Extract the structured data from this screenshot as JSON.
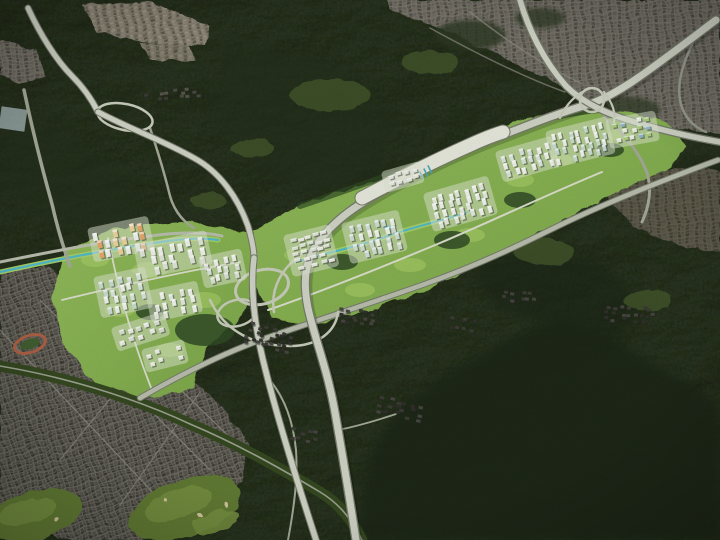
{
  "meta": {
    "type": "aerial-masterplan-rendering",
    "description": "Oblique aerial rendering of a planned new town: white apartment towers and green parks inserted along a highway corridor between dark forested mountains, with existing dense gray city districts and two major freeway interchanges.",
    "width": 720,
    "height": 540
  },
  "colors": {
    "forest_base": "#2b3721",
    "forest_dark": "#1b2516",
    "forest_shade": "#232e1b",
    "meadow": "#42552c",
    "city_bg": "#6b695f",
    "citygray_bg": "#767268",
    "beige_bg": "#847d6c",
    "dev_base": "#84ae4f",
    "dev_light": "#a6cc66",
    "park_dark": "#2f4a24",
    "golf": "#5e7833",
    "golf_light": "#728c3e",
    "bunker": "#cfc39a",
    "track_ring": "#a95f43",
    "track_infield": "#3f5c2e",
    "greenhouse": "#aebfc2",
    "pond": "#55bcca",
    "toll_plaza": "#e6e8dc"
  },
  "class_colors": {
    "road-casing": "#75796b",
    "road-fill": "#cdd1c3",
    "road-bright": "#e4e6da",
    "road-arterial": "#b6bbaa",
    "road-minor": "#a2a796",
    "road-thin": "#95998b",
    "road-shadow": "rgba(0,0,0,0.18)",
    "stream": "#4db7c7",
    "stream-bank": "#a6cc66",
    "boulevard-band": "#33471f",
    "boulevard-line": "#9aa08e",
    "dev-road": "#d8dcc9",
    "loop-ramp": "#c6cab9",
    "street-line": "#8d8a80",
    "belt-trees": "#2f4a24"
  },
  "roads": {
    "r_topleft": "M28,8 C40,34 56,60 72,76 C84,88 92,100 98,112",
    "r_topleft2": "M98,112 C128,128 162,140 194,158 C220,172 238,198 248,226 C252,240 254,250 254,258",
    "r_south_a": "M254,258 C250,290 255,330 266,372 C278,420 296,478 316,540",
    "expressway": "M356,540 C348,488 342,452 336,418 C328,370 315,340 308,308 C302,278 306,258 320,240 C338,216 365,200 395,184 C432,164 472,146 508,133 C536,122 562,112 590,104 C615,95 640,77 668,56 C690,40 705,28 716,20",
    "expressway_bright": "M362,198 C398,179 434,161 470,145 C483,139 493,135 503,132",
    "expressway2": "M520,0 C528,28 543,60 566,86 C580,100 598,110 622,118 C652,128 686,136 720,142",
    "arterial": "M140,398 C185,372 230,350 272,336 C330,316 380,300 425,284 C470,268 510,250 550,230 C590,210 650,185 718,160",
    "north_arterial_west": "M0,262 C50,252 100,242 150,236 C180,232 205,232 222,236",
    "stream_west": "M0,272 C55,260 115,248 168,241 C190,238 205,238 218,240",
    "stream_east": "M296,262 C330,252 360,246 382,238 C412,227 438,222 468,212",
    "left_road": "M24,90 C32,128 42,168 52,204 C57,226 62,244 70,266",
    "junction_spur": "M150,128 C158,152 164,172 169,192 C172,206 180,220 194,228",
    "ne_se_branch": "M604,116 C622,132 638,150 646,170 C652,186 650,205 642,222",
    "right_wind": "M700,28 C688,52 676,76 680,100 C683,116 692,126 706,132",
    "boulevard": "M0,366 C60,376 130,396 190,424 C235,443 275,465 320,492 C340,504 352,520 362,540",
    "village_road": "M268,378 C284,396 293,420 296,450 C298,478 294,508 288,540",
    "spur_hamlet": "M338,430 C358,426 378,420 396,414",
    "belt_road": "M268,310 C320,292 380,268 440,243 C492,221 544,196 602,172",
    "dev_road_w1": "M62,300 C120,286 180,272 240,262",
    "dev_road_w2": "M108,238 C118,288 132,340 152,390",
    "ramp1": "M210,300 C225,332 255,346 290,346 C320,346 336,330 338,312",
    "ramp2": "M302,254 C282,268 270,288 274,312",
    "belt_tree_line": "M300,206 C360,186 430,160 500,134 C540,120 570,112 600,110",
    "street_p2_a": "M430,28 C470,50 520,76 565,92",
    "street_p2_b": "M470,12 C505,40 545,66 582,84"
  },
  "regions": {
    "development_west": {
      "name": "western new-town cluster"
    },
    "development_east": {
      "name": "eastern new-town corridor"
    },
    "city_southwest": {
      "name": "existing dense low-rise city"
    },
    "city_northeast": {
      "name": "existing hillside city"
    },
    "interchange_central": {
      "name": "central freeway interchange"
    },
    "interchange_northeast": {
      "name": "northeast freeway crossing"
    }
  },
  "building_clusters": [
    {
      "id": "w-orange-towers",
      "x": 94,
      "y": 233,
      "a": -12,
      "r": 3,
      "c": 6,
      "dx": 9,
      "dy": 9,
      "w": 4.5,
      "h": 8,
      "j": 2,
      "seed": 1,
      "pad": true,
      "t": true,
      "p": [
        "#e2a566",
        "#ecd09c",
        "#edefe9"
      ]
    },
    {
      "id": "w-upper-towers",
      "x": 140,
      "y": 250,
      "a": -12,
      "r": 3,
      "c": 7,
      "dx": 9.5,
      "dy": 9,
      "w": 4.5,
      "h": 8,
      "j": 2,
      "seed": 2,
      "pad": true,
      "t": true,
      "p": [
        "#edefe9",
        "#dde3d8"
      ]
    },
    {
      "id": "w-teal-towers",
      "x": 100,
      "y": 282,
      "a": -12,
      "r": 4,
      "c": 5,
      "dx": 9,
      "dy": 8.5,
      "w": 4,
      "h": 7,
      "j": 2,
      "seed": 3,
      "pad": true,
      "t": true,
      "p": [
        "#c6dad0",
        "#edefe9",
        "#d7e2da"
      ]
    },
    {
      "id": "w-mid-towers",
      "x": 152,
      "y": 296,
      "a": -12,
      "r": 3,
      "c": 5,
      "dx": 9,
      "dy": 8,
      "w": 4,
      "h": 7,
      "j": 2,
      "seed": 4,
      "pad": true,
      "t": true,
      "p": [
        "#edefe9",
        "#e2e6db"
      ]
    },
    {
      "id": "w-low-blocks",
      "x": 118,
      "y": 332,
      "a": -18,
      "r": 2,
      "c": 5,
      "dx": 9.5,
      "dy": 8.5,
      "w": 5,
      "h": 4.5,
      "j": 2,
      "seed": 5,
      "pad": true,
      "t": true,
      "p": [
        "#e8eae2",
        "#d8dcd0"
      ]
    },
    {
      "id": "w-south-blocks",
      "x": 148,
      "y": 354,
      "a": -14,
      "r": 2,
      "c": 4,
      "dx": 9,
      "dy": 8,
      "w": 4.5,
      "h": 4,
      "j": 2,
      "seed": 6,
      "pad": true,
      "t": true,
      "p": [
        "#e8eae2"
      ]
    },
    {
      "id": "w-east-towers",
      "x": 205,
      "y": 262,
      "a": -12,
      "r": 3,
      "c": 4,
      "dx": 9,
      "dy": 8,
      "w": 4,
      "h": 6.5,
      "j": 2,
      "seed": 7,
      "pad": true,
      "t": true,
      "p": [
        "#edefe9",
        "#d9e0d5"
      ]
    },
    {
      "id": "e-slab-grid",
      "x": 290,
      "y": 240,
      "a": -14,
      "r": 5,
      "c": 5,
      "dx": 8,
      "dy": 7,
      "w": 6,
      "h": 3.2,
      "j": 1.5,
      "seed": 8,
      "pad": true,
      "t": true,
      "p": [
        "#e9ebe3",
        "#dde1d6"
      ]
    },
    {
      "id": "e-towers-1",
      "x": 348,
      "y": 228,
      "a": -14,
      "r": 4,
      "c": 6,
      "dx": 8.5,
      "dy": 8.5,
      "w": 4,
      "h": 7,
      "j": 2,
      "seed": 9,
      "pad": true,
      "t": true,
      "p": [
        "#edefe9",
        "#cfdcd4"
      ]
    },
    {
      "id": "e-towers-2",
      "x": 430,
      "y": 198,
      "a": -16,
      "r": 4,
      "c": 7,
      "dx": 8.5,
      "dy": 8,
      "w": 4,
      "h": 7,
      "j": 2,
      "seed": 10,
      "pad": true,
      "t": true,
      "p": [
        "#edefe9",
        "#e2e6db"
      ]
    },
    {
      "id": "e-north-blocks",
      "x": 388,
      "y": 176,
      "a": -16,
      "r": 2,
      "c": 4,
      "dx": 8,
      "dy": 7,
      "w": 5,
      "h": 3.5,
      "j": 1.5,
      "seed": 11,
      "pad": true,
      "t": true,
      "p": [
        "#e4e7dd"
      ]
    },
    {
      "id": "e-towers-3",
      "x": 502,
      "y": 156,
      "a": -16,
      "r": 3,
      "c": 6,
      "dx": 8.5,
      "dy": 8,
      "w": 4,
      "h": 6.5,
      "j": 2,
      "seed": 12,
      "pad": true,
      "t": true,
      "p": [
        "#edefe9",
        "#d7e2da"
      ]
    },
    {
      "id": "e-towers-4",
      "x": 552,
      "y": 136,
      "a": -14,
      "r": 4,
      "c": 7,
      "dx": 8,
      "dy": 7.5,
      "w": 3.5,
      "h": 6.5,
      "j": 2,
      "seed": 13,
      "pad": true,
      "t": true,
      "p": [
        "#edefe9",
        "#c6dad0"
      ]
    },
    {
      "id": "e-tip-blocks",
      "x": 612,
      "y": 124,
      "a": -10,
      "r": 3,
      "c": 5,
      "dx": 8.5,
      "dy": 7.5,
      "w": 4.5,
      "h": 4,
      "j": 2,
      "seed": 14,
      "pad": true,
      "t": true,
      "p": [
        "#8fb5c9",
        "#a9cc7e",
        "#e9ebe3"
      ]
    }
  ],
  "village_clusters": [
    {
      "id": "village-central",
      "x": 252,
      "y": 322,
      "a": 18,
      "r": 4,
      "c": 7,
      "dx": 7,
      "dy": 6,
      "w": 4,
      "h": 3,
      "j": 3,
      "seed": 15,
      "p": [
        "#3b3a34",
        "#454440",
        "#2f2e29"
      ]
    },
    {
      "id": "village-east-1",
      "x": 342,
      "y": 306,
      "a": 10,
      "r": 3,
      "c": 5,
      "dx": 7.5,
      "dy": 6,
      "w": 4,
      "h": 3,
      "j": 3,
      "seed": 16,
      "p": [
        "#3b3a34",
        "#454440",
        "#2f2e29"
      ]
    },
    {
      "id": "village-south",
      "x": 382,
      "y": 396,
      "a": 14,
      "r": 3,
      "c": 6,
      "dx": 7.5,
      "dy": 6.5,
      "w": 4.5,
      "h": 3,
      "j": 3,
      "seed": 17,
      "p": [
        "#3b3a34",
        "#454440",
        "#2f2e29"
      ]
    },
    {
      "id": "village-right",
      "x": 606,
      "y": 306,
      "a": 0,
      "r": 3,
      "c": 7,
      "dx": 7,
      "dy": 6,
      "w": 4,
      "h": 3,
      "j": 3,
      "seed": 18,
      "p": [
        "#3b3a34",
        "#454440",
        "#2f2e29"
      ]
    },
    {
      "id": "village-top-strip",
      "x": 145,
      "y": 94,
      "a": -6,
      "r": 2,
      "c": 8,
      "dx": 7,
      "dy": 6,
      "w": 4,
      "h": 3,
      "j": 2.5,
      "seed": 19,
      "p": [
        "#4a4842",
        "#56544c",
        "#3b3a34"
      ]
    },
    {
      "id": "village-midright",
      "x": 505,
      "y": 290,
      "a": 8,
      "r": 2,
      "c": 5,
      "dx": 7.5,
      "dy": 6,
      "w": 4,
      "h": 3,
      "j": 3,
      "seed": 20,
      "p": [
        "#3b3a34",
        "#454440"
      ]
    },
    {
      "id": "village-lower",
      "x": 292,
      "y": 428,
      "a": 12,
      "r": 2,
      "c": 4,
      "dx": 7.5,
      "dy": 6.5,
      "w": 4.5,
      "h": 3,
      "j": 3,
      "seed": 21,
      "p": [
        "#3b3a34",
        "#454440"
      ]
    },
    {
      "id": "village-belt-se",
      "x": 452,
      "y": 318,
      "a": 10,
      "r": 2,
      "c": 4,
      "dx": 7,
      "dy": 6,
      "w": 4,
      "h": 3,
      "j": 3,
      "seed": 22,
      "p": [
        "#3b3a34",
        "#2f2e29"
      ]
    }
  ]
}
